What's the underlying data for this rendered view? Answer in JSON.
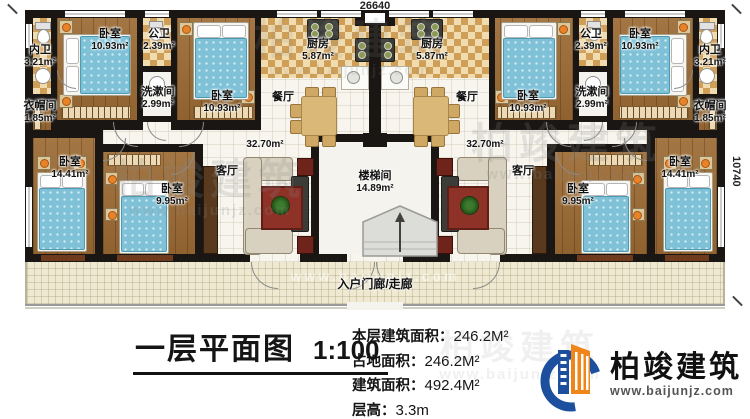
{
  "dimensions": {
    "top": "26640",
    "right": "10740"
  },
  "rooms": {
    "neiwei": {
      "name": "内卫",
      "area": "3.21m²"
    },
    "bed_outer": {
      "name": "卧室",
      "area": "10.93m²"
    },
    "gongwei": {
      "name": "公卫",
      "area": "2.39m²"
    },
    "xishujian": {
      "name": "洗漱间",
      "area": "2.99m²"
    },
    "bed_inner": {
      "name": "卧室",
      "area": "10.93m²"
    },
    "kitchen": {
      "name": "厨房",
      "area": "5.87m²"
    },
    "dining": {
      "name": "餐厅"
    },
    "yimaojian": {
      "name": "衣帽间",
      "area": "1.85m²"
    },
    "bed_large": {
      "name": "卧室",
      "area": "14.41m²"
    },
    "bed_small": {
      "name": "卧室",
      "area": "9.95m²"
    },
    "living": {
      "name": "客厅",
      "area": "32.70m²"
    },
    "stair": {
      "name": "楼梯间",
      "area": "14.89m²"
    },
    "porch": {
      "name": "入户门廊/走廊"
    }
  },
  "title_block": {
    "title": "一层平面图",
    "scale": "1:100",
    "stats": [
      {
        "label": "本层建筑面积：",
        "value": "246.2M²"
      },
      {
        "label": "占地面积：",
        "value": "246.2M²"
      },
      {
        "label": "建筑面积：",
        "value": "492.4M²"
      },
      {
        "label": "层高：",
        "value": "3.3m"
      }
    ]
  },
  "brand": {
    "name": "柏竣建筑",
    "site": "www.baijunjz.com"
  },
  "watermark": {
    "name": "柏竣建筑",
    "site": "www.baijunjz.com"
  }
}
